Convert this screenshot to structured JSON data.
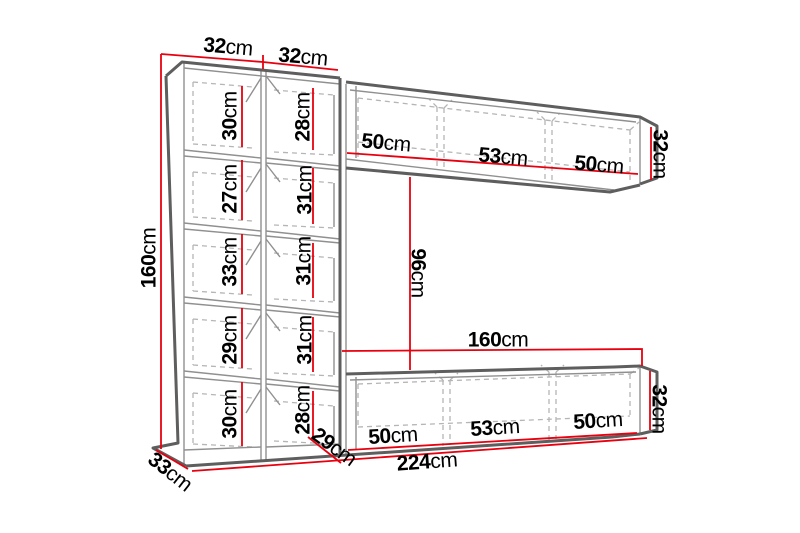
{
  "diagram": {
    "kind": "furniture-dimension-drawing",
    "subject": "wall unit entertainment center with measurements",
    "unit": "cm"
  },
  "colors": {
    "background": "#ffffff",
    "dimension_line": "#e8000f",
    "outline": "#5e5e5e",
    "inner_line": "#909090",
    "hidden_line": "#b5b5b5",
    "text": "#000000"
  },
  "dims": {
    "top_widths": [
      {
        "v": "32",
        "u": "cm"
      },
      {
        "v": "32",
        "u": "cm"
      }
    ],
    "left_height": {
      "v": "160",
      "u": "cm"
    },
    "left_col_cells": [
      {
        "v": "30",
        "u": "cm"
      },
      {
        "v": "27",
        "u": "cm"
      },
      {
        "v": "33",
        "u": "cm"
      },
      {
        "v": "29",
        "u": "cm"
      },
      {
        "v": "30",
        "u": "cm"
      }
    ],
    "mid_col_cells": [
      {
        "v": "28",
        "u": "cm"
      },
      {
        "v": "31",
        "u": "cm"
      },
      {
        "v": "31",
        "u": "cm"
      },
      {
        "v": "31",
        "u": "cm"
      },
      {
        "v": "28",
        "u": "cm"
      }
    ],
    "top_cabinet_sections": [
      {
        "v": "50",
        "u": "cm"
      },
      {
        "v": "53",
        "u": "cm"
      },
      {
        "v": "50",
        "u": "cm"
      }
    ],
    "top_cabinet_height": {
      "v": "32",
      "u": "cm"
    },
    "opening_height": {
      "v": "96",
      "u": "cm"
    },
    "opening_width": {
      "v": "160",
      "u": "cm"
    },
    "bottom_cabinet_sections": [
      {
        "v": "50",
        "u": "cm"
      },
      {
        "v": "53",
        "u": "cm"
      },
      {
        "v": "50",
        "u": "cm"
      }
    ],
    "bottom_cabinet_height": {
      "v": "32",
      "u": "cm"
    },
    "total_width": {
      "v": "224",
      "u": "cm"
    },
    "bottom_cabinet_depth": {
      "v": "29",
      "u": "cm"
    },
    "side_depth": {
      "v": "33",
      "u": "cm"
    }
  }
}
